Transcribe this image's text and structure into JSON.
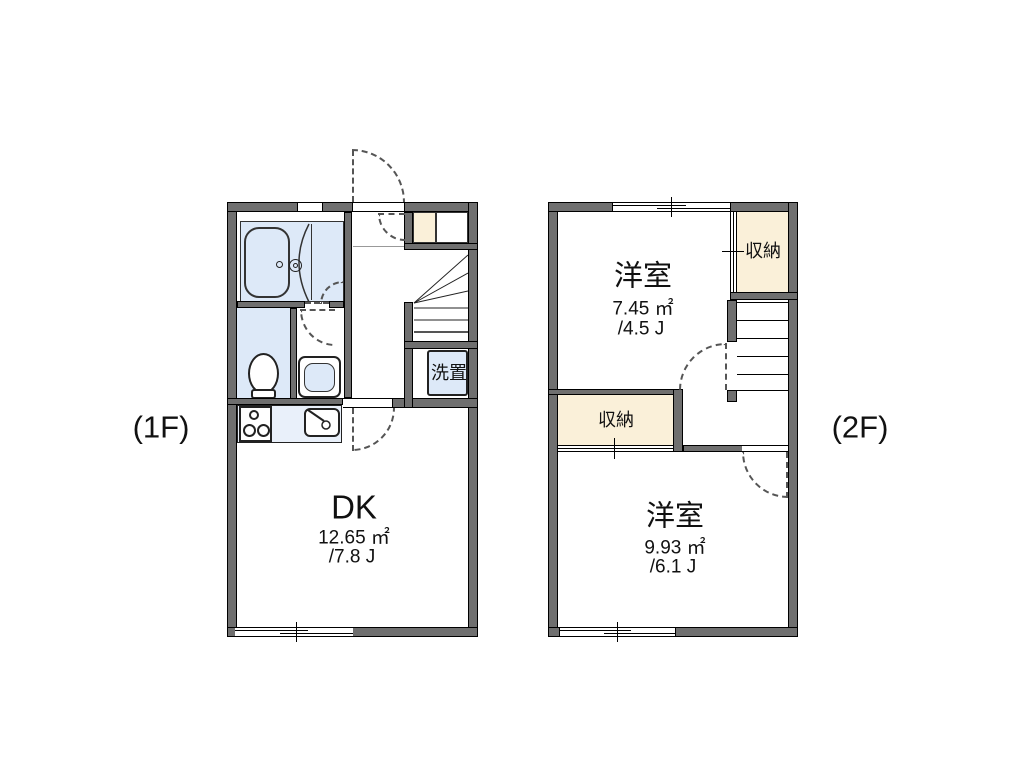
{
  "floor1": {
    "floor_label": "(1F)",
    "rooms": {
      "dk": {
        "label": "DK",
        "area": "12.65 ㎡",
        "tatami": "/7.8 J"
      },
      "washer": {
        "label": "洗置"
      }
    }
  },
  "floor2": {
    "floor_label": "(2F)",
    "rooms": {
      "room_top": {
        "label": "洋室",
        "area": "7.45 ㎡",
        "tatami": "/4.5 J"
      },
      "closet_top": {
        "label": "収納"
      },
      "closet_mid": {
        "label": "収納"
      },
      "room_bottom": {
        "label": "洋室",
        "area": "9.93 ㎡",
        "tatami": "/6.1 J"
      }
    }
  },
  "colors": {
    "wall": "#6f6f6f",
    "fixture_fill": "#dde9f8",
    "closet_fill": "#faf0d9",
    "door_dash": "#555"
  }
}
